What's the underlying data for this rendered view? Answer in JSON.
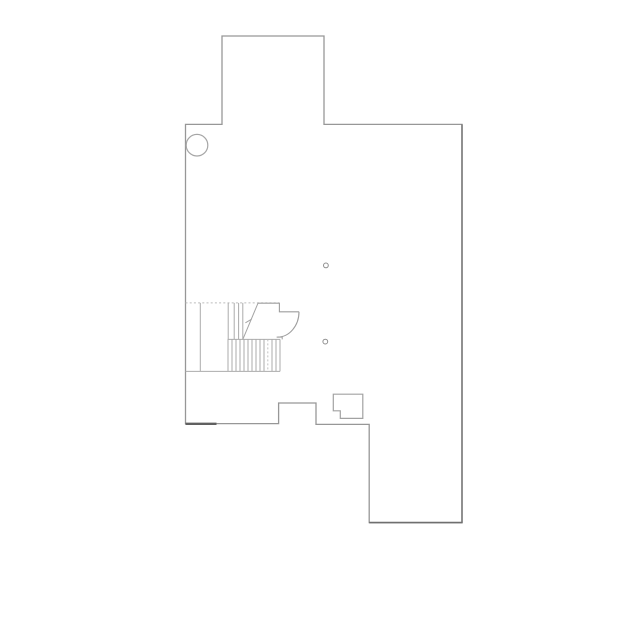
{
  "page": {
    "width": 639,
    "height": 639,
    "background": "#ffffff",
    "drawing_type": "floor-plan"
  },
  "colors": {
    "outline": "#979797",
    "accent_dark": "#6f6f6f",
    "threshold_dark": "#606060",
    "stair_light": "#ababab",
    "dotted_light": "#bcbcbc",
    "door": "#9e9e9e",
    "fixture": "#a2a2a2"
  },
  "floor_plan": {
    "shapes": [
      {
        "name": "building-outline",
        "type": "path",
        "d": "M 222 36 H 324 V 124.4 H 462 V 522.6 H 369.2 V 424.4 H 316 V 403 H 278.6 V 423.6 H 185.5 V 124.4 H 222 Z",
        "stroke": "#979797",
        "width": 1.3
      },
      {
        "name": "right-wall-accent-line",
        "type": "path",
        "d": "M 462 124.4 V 522.6",
        "stroke": "#6f6f6f",
        "width": 1.4
      },
      {
        "name": "rear-extension-accent-line",
        "type": "path",
        "d": "M 369.2 522.6 H 462.6",
        "stroke": "#6f6f6f",
        "width": 1.6
      },
      {
        "name": "entry-threshold-line",
        "type": "path",
        "d": "M 185.5 423.8 H 216.5",
        "stroke": "#606060",
        "width": 2.4
      },
      {
        "name": "corner-column-circle",
        "type": "circle",
        "cx": 197,
        "cy": 145.2,
        "r": 10.8,
        "stroke": "#a6a6a6",
        "width": 1.2
      },
      {
        "name": "support-post-circle-upper",
        "type": "circle",
        "cx": 325.9,
        "cy": 265.4,
        "r": 2.4,
        "stroke": "#8f8f8f",
        "width": 1
      },
      {
        "name": "support-post-circle-lower",
        "type": "circle",
        "cx": 325.3,
        "cy": 341.6,
        "r": 2.4,
        "stroke": "#8f8f8f",
        "width": 1
      },
      {
        "name": "stair-top-edge-dotted-line",
        "type": "path",
        "d": "M 185.5 302.9 H 279",
        "stroke": "#bcbcbc",
        "width": 1,
        "dash": "2 2.2"
      },
      {
        "name": "stair-side-wall-line",
        "type": "path",
        "d": "M 200.3 302.9 V 371.4",
        "stroke": "#ababab",
        "width": 1
      },
      {
        "name": "stair-upper-tread-lines",
        "type": "path",
        "d": "M 228.2 302.9 V 339.4 M 234.2 302.9 V 339.4 M 238.6 302.9 V 339.4 M 242.8 302.9 V 339.4",
        "stroke": "#ababab",
        "width": 1
      },
      {
        "name": "stair-landing-line",
        "type": "path",
        "d": "M 227.7 339.4 H 280",
        "stroke": "#ababab",
        "width": 1
      },
      {
        "name": "stair-lower-tread-lines",
        "type": "path",
        "d": "M 228 339.4 V 371.4 M 232 339.4 V 371.4 M 236 339.4 V 371.4 M 240 339.4 V 371.4 M 244 339.4 V 371.4 M 248 339.4 V 371.4 M 252 339.4 V 371.4 M 256 339.4 V 371.4 M 260 339.4 V 371.4 M 264 339.4 V 371.4 M 272 339.4 V 371.4 M 276 339.4 V 371.4 M 280 339.4 V 371.4",
        "stroke": "#ababab",
        "width": 1
      },
      {
        "name": "stair-walk-line-dashed",
        "type": "path",
        "d": "M 267.8 339.4 V 371.4",
        "stroke": "#c2c2c2",
        "width": 1,
        "dash": "2 2"
      },
      {
        "name": "stair-bottom-edge-line",
        "type": "path",
        "d": "M 185.5 371.4 H 280",
        "stroke": "#ababab",
        "width": 1
      },
      {
        "name": "stair-break-line",
        "type": "path",
        "d": "M 242.8 339.4 L 258 303.2",
        "stroke": "#a4a4a4",
        "width": 1
      },
      {
        "name": "stair-break-tick-line",
        "type": "path",
        "d": "M 245.4 322.8 L 251.6 319.2",
        "stroke": "#a4a4a4",
        "width": 1
      },
      {
        "name": "closet-door-header-line",
        "type": "path",
        "d": "M 258 303.2 H 279.4 V 311.8 H 299",
        "stroke": "#9e9e9e",
        "width": 1.1
      },
      {
        "name": "door-swing-arc",
        "type": "path",
        "d": "M 299 311.8 A 21.5 25.3 0 0 1 277.5 337.1",
        "stroke": "#9e9e9e",
        "width": 1.1
      },
      {
        "name": "door-sill-line",
        "type": "path",
        "d": "M 276.6 337.1 H 282.2 L 282.2 339.4",
        "stroke": "#9e9e9e",
        "width": 1
      },
      {
        "name": "fireplace-outline",
        "type": "path",
        "d": "M 333.3 394.2 H 362.8 V 418.4 H 340.3 V 410.8 H 333.3 Z",
        "stroke": "#a2a2a2",
        "width": 1.2
      }
    ]
  }
}
